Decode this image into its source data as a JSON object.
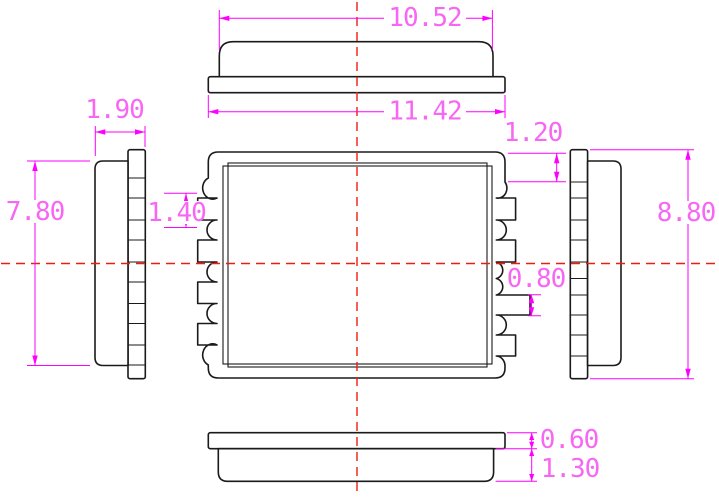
{
  "drawing": {
    "kind": "mechanical dimension drawing",
    "component": "castellated SMD module package, five orthographic views"
  },
  "colors": {
    "background": "#ffffff",
    "geometry": "#1a1a1a",
    "dimension": "#ff00ff",
    "dimension_text": "#f767f3",
    "centerline": "#ec1c12"
  },
  "dimensions": {
    "cover_width": "10.52",
    "base_width": "11.42",
    "side_total_thickness": "1.90",
    "body_height": "7.80",
    "pad_pitch": "1.40",
    "pad_top_offset": "1.20",
    "pad_width": "0.80",
    "base_height": "8.80",
    "base_plate_thickness": "0.60",
    "cover_thickness": "1.30"
  }
}
